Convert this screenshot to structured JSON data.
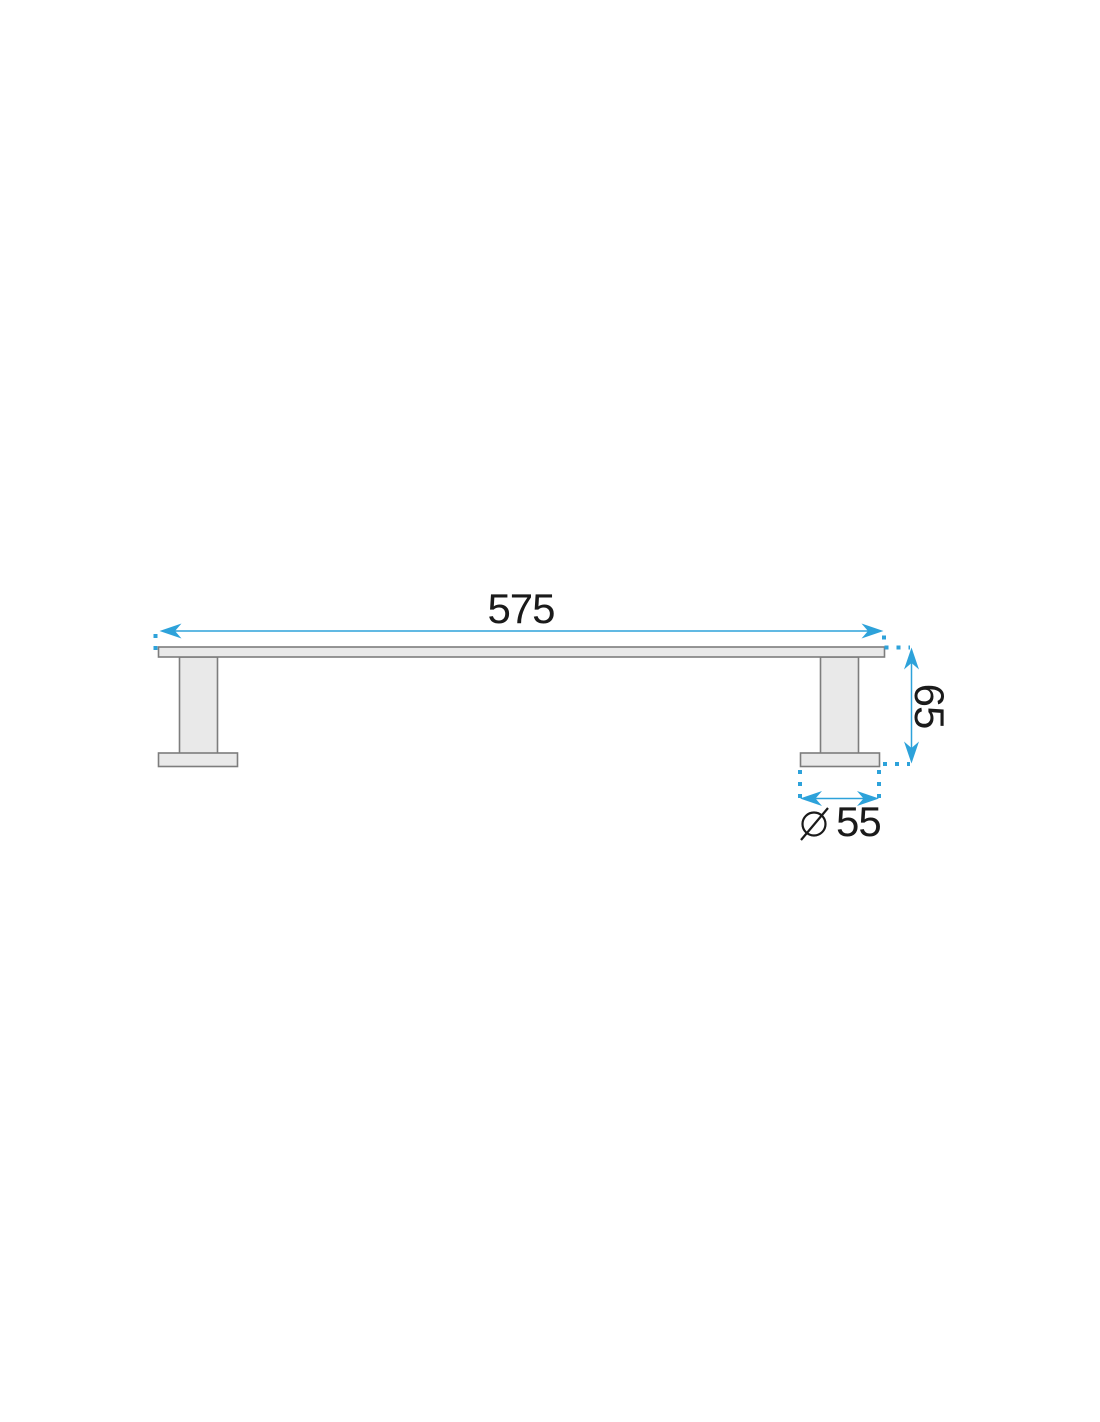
{
  "document": {
    "kind": "technical dimension drawing",
    "background_color": "#ffffff"
  },
  "drawing": {
    "colors": {
      "dimension_blue": "#2da2da",
      "part_fill": "#e9e9e9",
      "part_outline": "#7d7d7d",
      "text_black": "#1a1a1a"
    },
    "dimensions": {
      "length": {
        "value": "575"
      },
      "height": {
        "value": "65"
      },
      "base_diameter": {
        "value": "55",
        "symbol": "diameter-sign"
      }
    }
  }
}
